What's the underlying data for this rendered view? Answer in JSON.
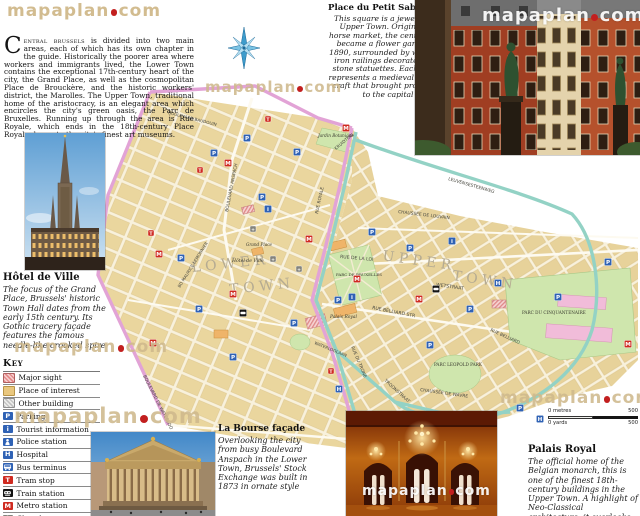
{
  "logo": {
    "pre": "mapaplan",
    "post": "com"
  },
  "intro": {
    "drop_cap": "C",
    "lead": "entral brussels",
    "body": " is divided into two main areas, each of which has its own chapter in the guide. Historically the poorer area where workers and immigrants lived, the Lower Town contains the exceptional 17th-century heart of the city, the Grand Place, as well as the cosmopolitan Place de Brouckère, and the historic workers' district, the Marolles. The Upper Town, traditional home of the aristocracy, is an elegant area which encircles the city's green oasis, the Parc de Bruxelles. Running up through the area is Rue Royale, which ends in the 18th-century Place Royale, home to the city's finest art museums."
  },
  "petit_sablon": {
    "title": "Place du Petit Sablon",
    "body": "This square is a jewel of the Upper Town. Originally a horse market, the central area became a flower garden in 1890, surrounded by wrought-iron railings decorated with stone statuettes. Each figure represents a medieval trade or craft that brought prosperity to the capital"
  },
  "hotel_de_ville": {
    "title": "Hôtel de Ville",
    "body": "The focus of the Grand Place, Brussels' historic Town Hall dates from the early 15th century. Its Gothic tracery façade features the famous needle-like crooked spire"
  },
  "la_bourse": {
    "title": "La Bourse façade",
    "body": "Overlooking the city from busy Boulevard Anspach in the Lower Town, Brussels' Stock Exchange was built in 1873 in ornate style"
  },
  "palais_royal": {
    "title": "Palais Royal",
    "body": "The official home of the Belgian monarch, this is one of the finest 18th-century buildings in the Upper Town. A highlight of Neo-Classical architecture, it overlooks Parc de Bruxelles"
  },
  "legend": {
    "title": "Key",
    "items": [
      {
        "label": "Major sight",
        "kind": "hatch-red"
      },
      {
        "label": "Place of interest",
        "kind": "solid-tan"
      },
      {
        "label": "Other building",
        "kind": "hatch-gray"
      },
      {
        "label": "Parking",
        "kind": "sq",
        "glyph": "P",
        "bg": "#2f62b5"
      },
      {
        "label": "Tourist information",
        "kind": "sq",
        "glyph": "i",
        "bg": "#2f62b5"
      },
      {
        "label": "Police station",
        "kind": "police",
        "bg": "#2f62b5"
      },
      {
        "label": "Hospital",
        "kind": "sq",
        "glyph": "H",
        "bg": "#2f62b5"
      },
      {
        "label": "Bus terminus",
        "kind": "bus",
        "bg": "#2f62b5"
      },
      {
        "label": "Tram stop",
        "kind": "sq",
        "glyph": "T",
        "bg": "#cf2a20"
      },
      {
        "label": "Train station",
        "kind": "train",
        "bg": "#141414"
      },
      {
        "label": "Metro station",
        "kind": "sq",
        "glyph": "M",
        "bg": "#cf2a20"
      },
      {
        "label": "Church",
        "kind": "church",
        "bg": "#84847c"
      }
    ]
  },
  "scale": {
    "metres_zero": "0 metres",
    "metres_max": "500",
    "yards_zero": "0 yards",
    "yards_max": "500"
  },
  "watermarks": [
    {
      "x": 205,
      "y": 78,
      "s": 15,
      "c": "tan"
    },
    {
      "x": 14,
      "y": 337,
      "s": 17,
      "c": "tan"
    },
    {
      "x": 14,
      "y": 404,
      "s": 21,
      "c": "tan"
    },
    {
      "x": 500,
      "y": 388,
      "s": 17,
      "c": "tan"
    },
    {
      "x": 482,
      "y": 5,
      "s": 18,
      "c": "white"
    },
    {
      "x": 362,
      "y": 483,
      "s": 14,
      "c": "white"
    }
  ],
  "map": {
    "colors": {
      "cream": "#f8f1dc",
      "block_tan": "#ead69e",
      "road_pink": "#e2a3d6",
      "road_teal": "#93d2c5",
      "park_green": "#cfe6ad",
      "icon_blue": "#2f62b5",
      "icon_red": "#cf2a20",
      "district_gray": "#b5ab92"
    },
    "district_labels": [
      {
        "t": "L O W E R",
        "x": 192,
        "y": 272,
        "r": -6,
        "s": 14
      },
      {
        "t": "T O W N",
        "x": 230,
        "y": 294,
        "r": -6,
        "s": 14
      },
      {
        "t": "U P P E R",
        "x": 382,
        "y": 260,
        "r": 8,
        "s": 14
      },
      {
        "t": "T O W N",
        "x": 452,
        "y": 280,
        "r": 8,
        "s": 14
      }
    ],
    "street_labels": [
      {
        "t": "BOULEVARD ANSPACH",
        "x": 228,
        "y": 212,
        "r": -79,
        "s": 4.4
      },
      {
        "t": "BD MAURICE LEMONNIER",
        "x": 180,
        "y": 288,
        "r": -58,
        "s": 4.2
      },
      {
        "t": "BOULEVARD DE WATERLOO",
        "x": 143,
        "y": 376,
        "r": 63,
        "s": 4.4
      },
      {
        "t": "RUE ROYALE",
        "x": 318,
        "y": 214,
        "r": -78,
        "s": 4.4
      },
      {
        "t": "KRUIDTUIN",
        "x": 336,
        "y": 150,
        "r": -40,
        "s": 4.2
      },
      {
        "t": "RUE DE LA LOI",
        "x": 340,
        "y": 258,
        "r": 5,
        "s": 4.6
      },
      {
        "t": "WETSTRAAT",
        "x": 436,
        "y": 286,
        "r": 8,
        "s": 4.6
      },
      {
        "t": "CHAUSSÉE DE LOUVAIN",
        "x": 398,
        "y": 213,
        "r": 7,
        "s": 4.4
      },
      {
        "t": "LEUVENSESTEENWEG",
        "x": 448,
        "y": 180,
        "r": 16,
        "s": 4.4
      },
      {
        "t": "RUE BELLIARD STR",
        "x": 372,
        "y": 309,
        "r": 11,
        "s": 4.6
      },
      {
        "t": "RUE BELLIARD",
        "x": 490,
        "y": 331,
        "r": 24,
        "s": 4.4
      },
      {
        "t": "RUE DU TRONE",
        "x": 351,
        "y": 347,
        "r": 67,
        "s": 4.4
      },
      {
        "t": "TROONSTRAAT",
        "x": 384,
        "y": 381,
        "r": 42,
        "s": 4.4
      },
      {
        "t": "CHAUSSÉE DE WAVRE",
        "x": 420,
        "y": 391,
        "r": 8,
        "s": 4.4
      },
      {
        "t": "WATERLOOLAAN",
        "x": 314,
        "y": 344,
        "r": 22,
        "s": 4.2
      },
      {
        "t": "BOULEVARD BAUDOUIN",
        "x": 168,
        "y": 114,
        "r": 14,
        "s": 4.2
      }
    ],
    "place_labels": [
      {
        "t": "Jardin Botanique",
        "x": 318,
        "y": 137,
        "s": 4.2,
        "i": true
      },
      {
        "t": "Grand Place",
        "x": 246,
        "y": 246,
        "s": 4.2,
        "i": true
      },
      {
        "t": "Hôtel de Ville",
        "x": 232,
        "y": 262,
        "s": 4.6,
        "i": true
      },
      {
        "t": "PARC DE BRUXELLES",
        "x": 336,
        "y": 276,
        "s": 4.0
      },
      {
        "t": "Palais Royal",
        "x": 330,
        "y": 318,
        "s": 4.4,
        "i": true
      },
      {
        "t": "PARC DU CINQUANTENAIRE",
        "x": 522,
        "y": 314,
        "s": 4.2
      },
      {
        "t": "PARC LEOPOLD PARK",
        "x": 434,
        "y": 366,
        "s": 4.2
      }
    ],
    "icons": [
      {
        "k": "P",
        "x": 214,
        "y": 153
      },
      {
        "k": "P",
        "x": 247,
        "y": 138
      },
      {
        "k": "P",
        "x": 297,
        "y": 152
      },
      {
        "k": "P",
        "x": 262,
        "y": 197
      },
      {
        "k": "P",
        "x": 181,
        "y": 258
      },
      {
        "k": "P",
        "x": 199,
        "y": 309
      },
      {
        "k": "P",
        "x": 233,
        "y": 357
      },
      {
        "k": "P",
        "x": 294,
        "y": 323
      },
      {
        "k": "P",
        "x": 338,
        "y": 300
      },
      {
        "k": "P",
        "x": 410,
        "y": 248
      },
      {
        "k": "P",
        "x": 470,
        "y": 309
      },
      {
        "k": "P",
        "x": 520,
        "y": 408
      },
      {
        "k": "P",
        "x": 558,
        "y": 297
      },
      {
        "k": "P",
        "x": 608,
        "y": 262
      },
      {
        "k": "P",
        "x": 372,
        "y": 232
      },
      {
        "k": "P",
        "x": 430,
        "y": 345
      },
      {
        "k": "M",
        "x": 228,
        "y": 163
      },
      {
        "k": "M",
        "x": 159,
        "y": 254
      },
      {
        "k": "M",
        "x": 233,
        "y": 294
      },
      {
        "k": "M",
        "x": 309,
        "y": 239
      },
      {
        "k": "M",
        "x": 357,
        "y": 279
      },
      {
        "k": "M",
        "x": 419,
        "y": 299
      },
      {
        "k": "M",
        "x": 153,
        "y": 343
      },
      {
        "k": "M",
        "x": 628,
        "y": 344
      },
      {
        "k": "M",
        "x": 346,
        "y": 128
      },
      {
        "k": "i",
        "x": 268,
        "y": 209
      },
      {
        "k": "i",
        "x": 352,
        "y": 297
      },
      {
        "k": "i",
        "x": 452,
        "y": 241
      },
      {
        "k": "H",
        "x": 339,
        "y": 389
      },
      {
        "k": "H",
        "x": 498,
        "y": 283
      },
      {
        "k": "H",
        "x": 540,
        "y": 419
      },
      {
        "k": "tram",
        "x": 151,
        "y": 233
      },
      {
        "k": "tram",
        "x": 268,
        "y": 119
      },
      {
        "k": "tram",
        "x": 430,
        "y": 129
      },
      {
        "k": "tram",
        "x": 331,
        "y": 371
      },
      {
        "k": "tram",
        "x": 200,
        "y": 170
      },
      {
        "k": "train",
        "x": 243,
        "y": 313
      },
      {
        "k": "train",
        "x": 436,
        "y": 289
      },
      {
        "k": "church",
        "x": 253,
        "y": 229
      },
      {
        "k": "church",
        "x": 273,
        "y": 259
      },
      {
        "k": "church",
        "x": 299,
        "y": 269
      }
    ]
  }
}
